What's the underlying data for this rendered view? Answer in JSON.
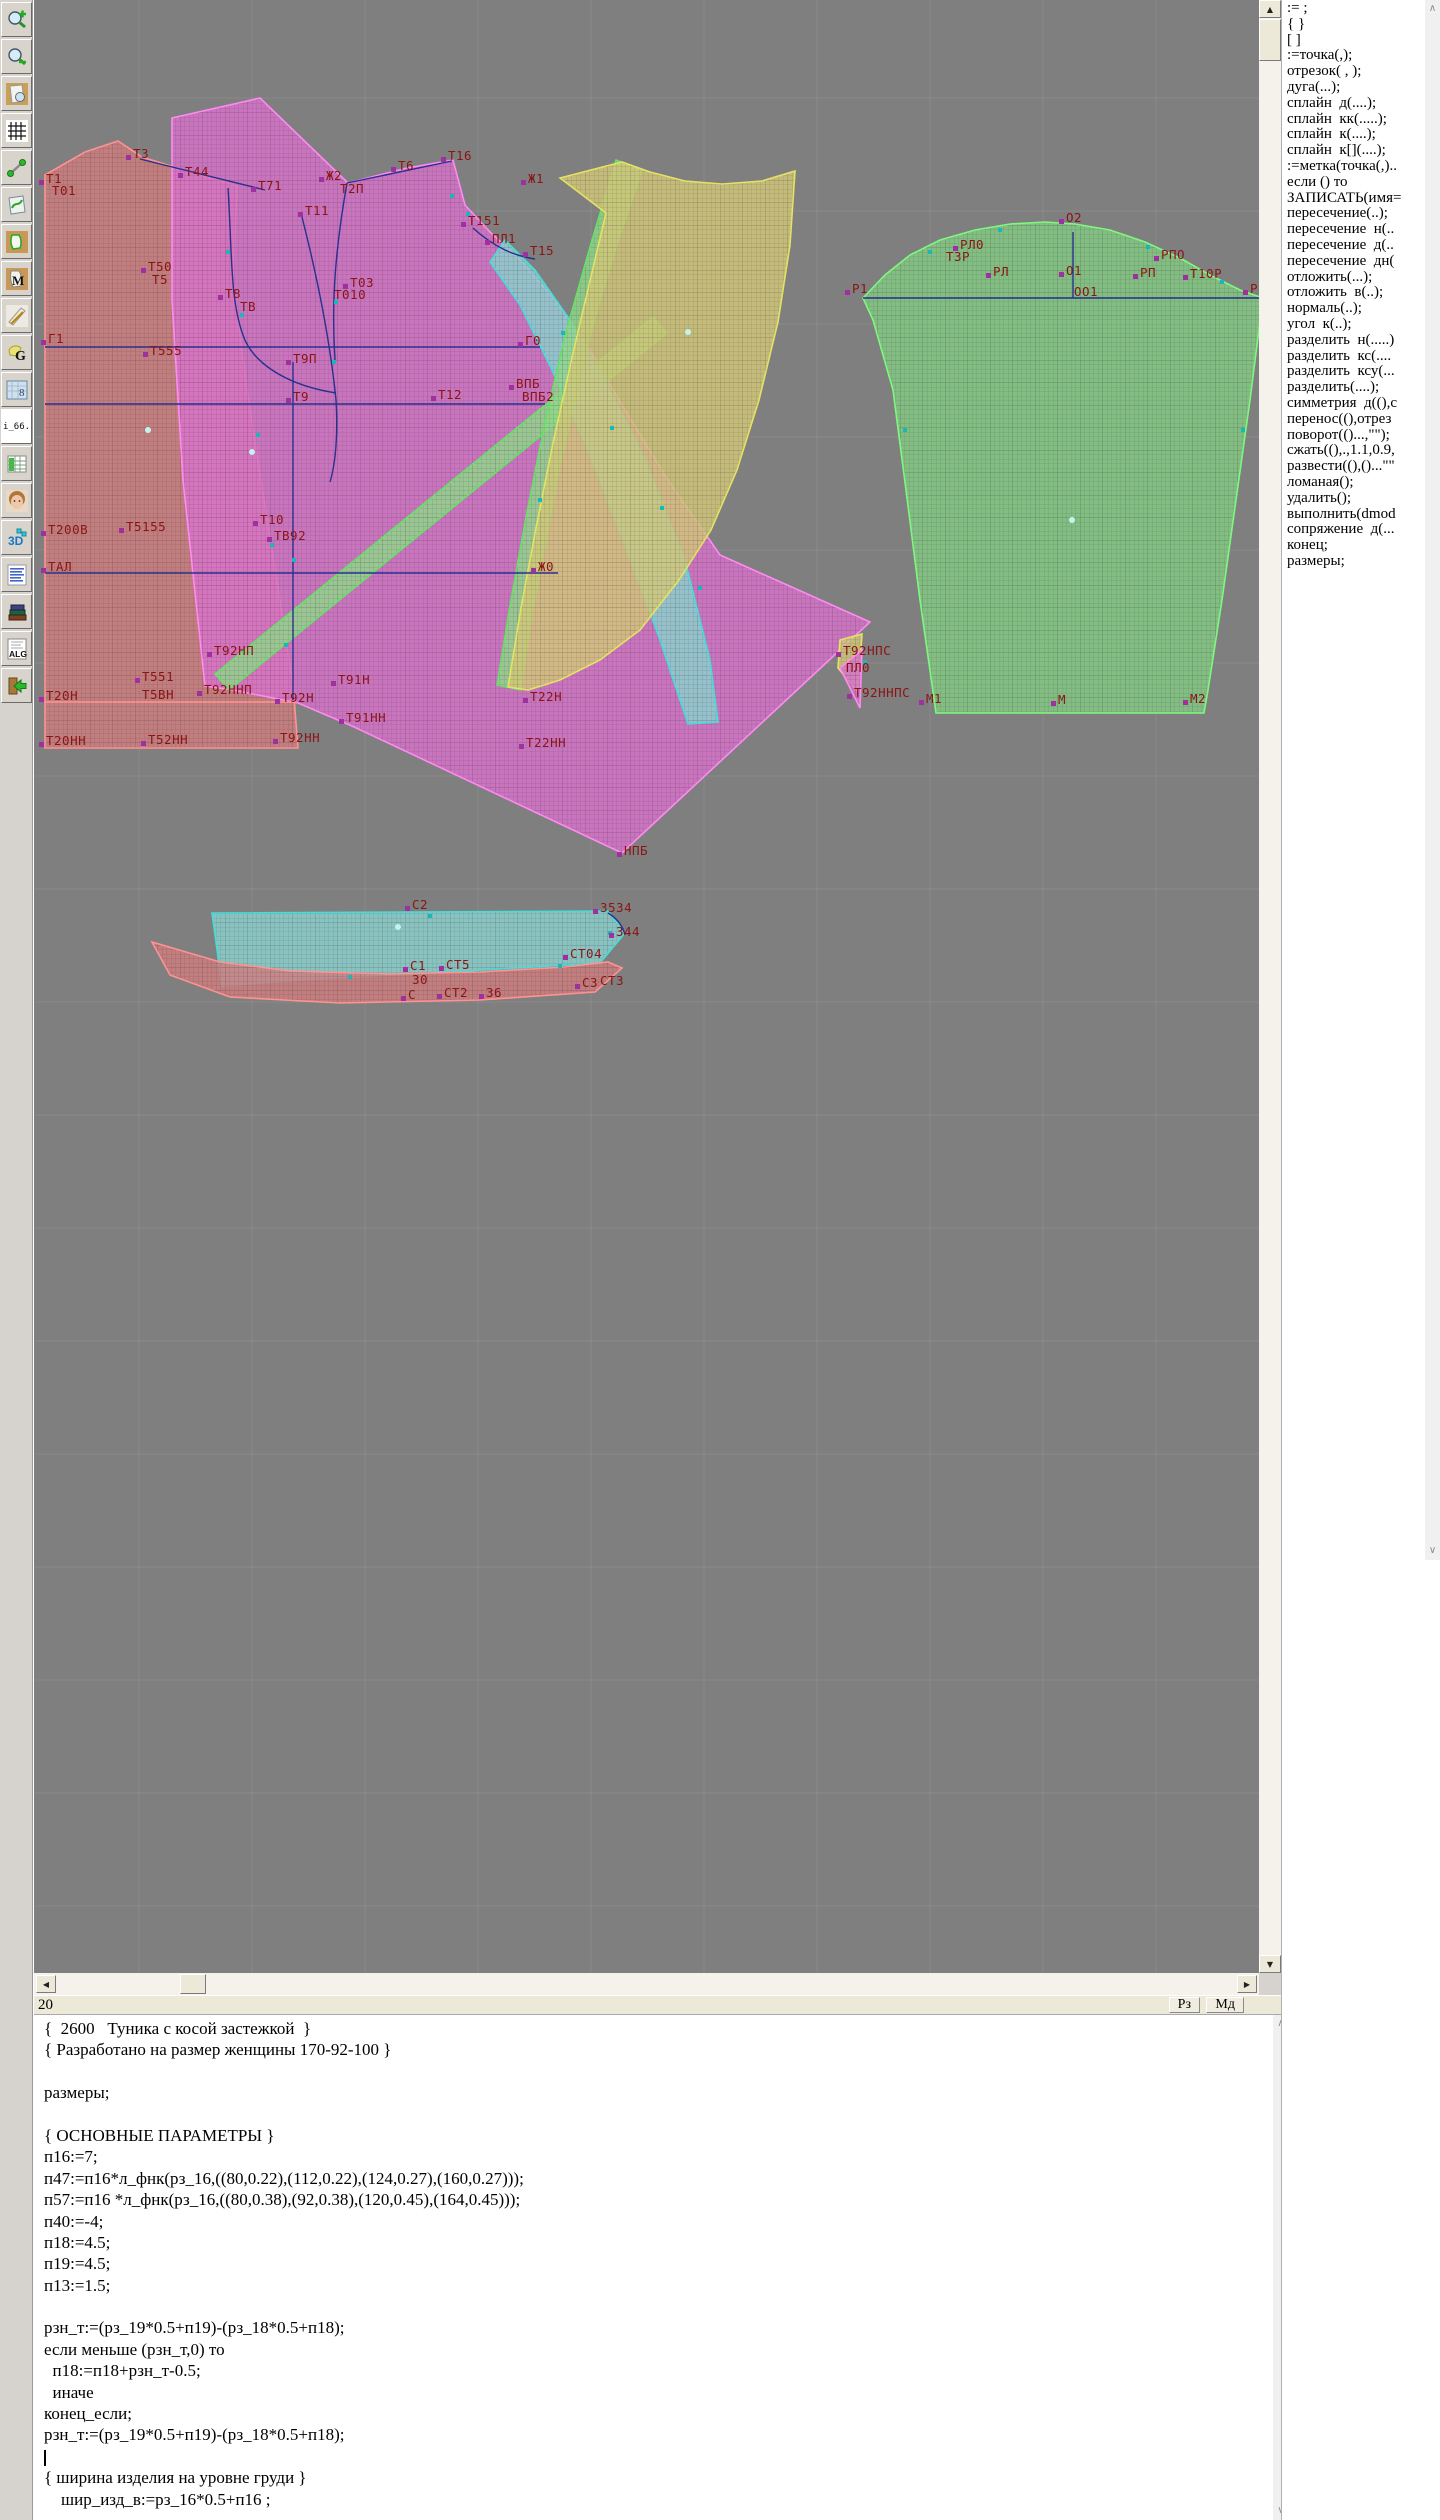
{
  "toolbar": {
    "buttons": [
      {
        "name": "zoom-in-button",
        "icon": "zoomin"
      },
      {
        "name": "zoom-out-button",
        "icon": "zoomout"
      },
      {
        "name": "preview-pattern-button",
        "icon": "preview"
      },
      {
        "name": "grid-button",
        "icon": "grid"
      },
      {
        "name": "measure-line-button",
        "icon": "measure"
      },
      {
        "name": "curves-button",
        "icon": "curvepage"
      },
      {
        "name": "pattern-piece-button",
        "icon": "piece"
      },
      {
        "name": "pattern-m-button",
        "icon": "pieceM"
      },
      {
        "name": "draft-tools-button",
        "icon": "ruler"
      },
      {
        "name": "pattern-g-button",
        "icon": "pieceG"
      },
      {
        "name": "blueprint-button",
        "icon": "blueprint"
      },
      {
        "name": "file-i66-button",
        "icon": "i66",
        "text": "i_66."
      },
      {
        "name": "size-table-button",
        "icon": "table"
      },
      {
        "name": "model-photo-button",
        "icon": "face"
      },
      {
        "name": "view-3d-button",
        "icon": "threed"
      },
      {
        "name": "text-list-button",
        "icon": "list"
      },
      {
        "name": "library-button",
        "icon": "books"
      },
      {
        "name": "algorithm-button",
        "icon": "alg"
      },
      {
        "name": "exit-button",
        "icon": "exit"
      }
    ]
  },
  "right_panel": {
    "items": [
      ":= ;",
      "{ }",
      "[ ]",
      ":=точка(,);",
      "отрезок( , );",
      "дуга(...);",
      "сплайн  д(....);",
      "сплайн  кк(.....);",
      "сплайн  к(....);",
      "сплайн  к[](....);",
      ":=метка(точка(,)..",
      "если () то",
      "ЗАПИСАТЬ(имя=",
      "пересечение(..);",
      "пересечение  н(..",
      "пересечение  д(..",
      "пересечение  дн(",
      "отложить(...);",
      "отложить  в(..);",
      "нормаль(..);",
      "угол  к(..);",
      "разделить  н(.....)",
      "разделить  кс(....",
      "разделить  ксу(...",
      "разделить(....);",
      "симметрия  д((),с",
      "перенос((),отрез",
      "поворот(()...,\"\");",
      "сжать((),.,1.1,0.9,",
      "развести((),()...\"\"",
      "ломаная();",
      "удалить();",
      "выполнить(dmod",
      "сопряжение  д(...",
      "конец;",
      "размеры;"
    ]
  },
  "status_bar": {
    "line_number": "20",
    "buttons": [
      "Рз",
      "Мд"
    ]
  },
  "editor": {
    "cursor_line": 20,
    "lines": [
      "{  2600   Туника с косой застежкой  }",
      "{ Разработано на размер женщины 170-92-100 }",
      "",
      "размеры;",
      "",
      "{ ОСНОВНЫЕ ПАРАМЕТРЫ }",
      "п16:=7;",
      "п47:=п16*л_фнк(рз_16,((80,0.22),(112,0.22),(124,0.27),(160,0.27)));",
      "п57:=п16 *л_фнк(рз_16,((80,0.38),(92,0.38),(120,0.45),(164,0.45)));",
      "п40:=-4;",
      "п18:=4.5;",
      "п19:=4.5;",
      "п13:=1.5;",
      "",
      "рзн_т:=(рз_19*0.5+п19)-(рз_18*0.5+п18);",
      "если меньше (рзн_т,0) то",
      "  п18:=п18+рзн_т-0.5;",
      "  иначе",
      "конец_если;",
      "рзн_т:=(рз_19*0.5+п19)-(рз_18*0.5+п18);",
      "",
      "{ ширина изделия на уровне груди }",
      "    шир_изд_в:=рз_16*0.5+п16 ;"
    ]
  },
  "canvas": {
    "bg": "#7f7f7f",
    "line_color": "#283090",
    "label_color": "#8b1414",
    "grid": {
      "step": 113,
      "x0": 139,
      "y0": 98,
      "color": "rgba(255,255,255,0.08)"
    },
    "pieces": [
      {
        "name": "back-bodice",
        "fill": "#cf7e7e",
        "stroke": "#ff9292",
        "pts": "45,175 85,152 118,141 142,157 200,175 237,186 233,280 247,390 264,500 280,600 293,685 298,748 45,748"
      },
      {
        "name": "front-bodice",
        "fill": "#d873cc",
        "stroke": "#ff8af2",
        "pts": "172,118 260,98 348,183 407,168 453,160 465,205 490,232 520,260 555,300 590,350 625,410 668,480 720,555 870,622 622,853 352,726 298,703 233,690 205,686 183,480 172,300"
      },
      {
        "name": "bias-band-long",
        "fill": "#8fd88a",
        "stroke": "#66e066",
        "pts": "653,317 667,333 229,690 215,674"
      },
      {
        "name": "side-panel-cyan",
        "fill": "#8ad2ce",
        "stroke": "#46dcd8",
        "pts": "505,240 535,270 570,320 605,380 645,460 685,560 710,660 718,722 688,724 660,640 625,545 588,450 552,370 520,305 490,262"
      },
      {
        "name": "bias-band-front",
        "fill": "#8fd88a",
        "stroke": "#66e066",
        "pts": "616,160 642,170 620,235 597,310 577,390 559,470 544,550 531,620 521,690 497,685 511,600 527,512 545,422 566,332 590,247"
      },
      {
        "name": "side-panel-yellow",
        "fill": "#d2c878",
        "stroke": "#e2e264",
        "pts": "560,178 622,162 650,172 685,181 722,184 762,181 795,171 790,245 778,322 759,400 737,470 711,530 679,580 640,630 600,660 560,680 528,690 508,687 521,608 536,528 553,443 573,353 593,268 606,213"
      },
      {
        "name": "sleeve",
        "fill": "#82ca82",
        "stroke": "#7ef87e",
        "pts": "863,298 885,275 910,255 940,240 975,230 1010,224 1045,222 1075,224 1110,230 1145,242 1180,258 1210,275 1240,290 1263,298 1250,400 1236,500 1222,600 1208,690 1204,713 936,713 920,600 906,490 893,390 873,320"
      },
      {
        "name": "gusset-yellow",
        "fill": "#d2c878",
        "stroke": "#e2e264",
        "pts": "840,640 862,634 858,692 838,668"
      },
      {
        "name": "gusset-magenta",
        "fill": "#d873cc",
        "stroke": "#ff8af2",
        "pts": "840,668 862,650 860,708"
      },
      {
        "name": "collar-band-cyan",
        "fill": "#8ad2ce",
        "stroke": "#46dcd8",
        "pts": "212,913 608,911 625,933 600,963 450,972 300,980 222,986"
      },
      {
        "name": "collar-band-red",
        "fill": "#cf7e7e",
        "stroke": "#ff9292",
        "pts": "152,942 220,962 290,971 390,974 480,972 565,967 608,962 622,968 595,992 480,1000 340,1003 230,997 170,975"
      }
    ],
    "paths": [
      {
        "d": "M45 347 H540"
      },
      {
        "d": "M45 404 H545"
      },
      {
        "d": "M45 573 H558"
      },
      {
        "d": "M293 362 V700"
      },
      {
        "d": "M140 159 L265 190"
      },
      {
        "d": "M347 183 L452 161"
      },
      {
        "d": "M228 188 C232 250 230 300 243 335 C252 362 285 385 336 393"
      },
      {
        "d": "M302 217 C318 280 330 340 336 400 C338 432 336 462 330 482"
      },
      {
        "d": "M347 183 C336 245 331 300 335 360"
      },
      {
        "d": "M473 228 C495 248 515 256 535 259"
      },
      {
        "d": "M863 298 H1263"
      },
      {
        "d": "M1073 232 V298"
      },
      {
        "d": "M608 913 C618 919 623 927 625 935"
      },
      {
        "d": "M45 702 H297",
        "s": "#ff9292"
      }
    ],
    "labels": [
      [
        46,
        183,
        "Т1",
        1
      ],
      [
        52,
        195,
        "Т01",
        0
      ],
      [
        133,
        158,
        "Т3",
        1
      ],
      [
        185,
        176,
        "Т44",
        1
      ],
      [
        258,
        190,
        "Т71",
        1
      ],
      [
        326,
        180,
        "Ж2",
        1
      ],
      [
        340,
        193,
        "Т2П",
        0
      ],
      [
        305,
        215,
        "Т11",
        1
      ],
      [
        398,
        170,
        "Т6",
        1
      ],
      [
        448,
        160,
        "Т16",
        1
      ],
      [
        528,
        183,
        "Ж1",
        1
      ],
      [
        468,
        225,
        "Т151",
        1
      ],
      [
        492,
        243,
        "ПЛ1",
        1
      ],
      [
        530,
        255,
        "Т15",
        1
      ],
      [
        148,
        271,
        "Т50",
        1
      ],
      [
        152,
        284,
        "Т5",
        0
      ],
      [
        225,
        298,
        "Т8",
        1
      ],
      [
        240,
        311,
        "ТВ",
        0
      ],
      [
        350,
        287,
        "Т03",
        1
      ],
      [
        334,
        299,
        "Т010",
        0
      ],
      [
        48,
        343,
        "Г1",
        1
      ],
      [
        150,
        355,
        "Т555",
        1
      ],
      [
        293,
        363,
        "Т9П",
        1
      ],
      [
        525,
        345,
        "Г0",
        1
      ],
      [
        293,
        401,
        "Т9",
        1
      ],
      [
        438,
        399,
        "Т12",
        1
      ],
      [
        516,
        388,
        "ВПБ",
        1
      ],
      [
        522,
        401,
        "ВПБ2",
        0
      ],
      [
        48,
        534,
        "Т200В",
        1
      ],
      [
        126,
        531,
        "Т5155",
        1
      ],
      [
        260,
        524,
        "Т10",
        1
      ],
      [
        274,
        540,
        "ТВ92",
        1
      ],
      [
        48,
        571,
        "ТАЛ",
        1
      ],
      [
        538,
        571,
        "Ж0",
        1
      ],
      [
        214,
        655,
        "Т92НП",
        1
      ],
      [
        142,
        681,
        "Т551",
        1
      ],
      [
        142,
        699,
        "Т5ВН",
        0
      ],
      [
        46,
        700,
        "Т20Н",
        1
      ],
      [
        204,
        694,
        "Т92ННП",
        1
      ],
      [
        282,
        702,
        "Т92Н",
        1
      ],
      [
        338,
        684,
        "Т91Н",
        1
      ],
      [
        346,
        722,
        "Т91НН",
        1
      ],
      [
        46,
        745,
        "Т20НН",
        1
      ],
      [
        148,
        744,
        "Т52НН",
        1
      ],
      [
        280,
        742,
        "Т92НН",
        1
      ],
      [
        530,
        701,
        "Т22Н",
        1
      ],
      [
        526,
        747,
        "Т22НН",
        1
      ],
      [
        624,
        855,
        "НПБ",
        1
      ],
      [
        843,
        655,
        "Т92НПС",
        1
      ],
      [
        846,
        672,
        "ПЛ0",
        0
      ],
      [
        854,
        697,
        "Т92ННПС",
        1
      ],
      [
        852,
        293,
        "Р1",
        1
      ],
      [
        1066,
        222,
        "О2",
        1
      ],
      [
        960,
        249,
        "РЛ0",
        1
      ],
      [
        946,
        261,
        "Т3Р",
        0
      ],
      [
        993,
        276,
        "РЛ",
        1
      ],
      [
        1066,
        275,
        "О1",
        1
      ],
      [
        1074,
        296,
        "ОО1",
        0
      ],
      [
        1140,
        277,
        "РП",
        1
      ],
      [
        1161,
        259,
        "РПО",
        1
      ],
      [
        1190,
        278,
        "Т10Р",
        1
      ],
      [
        1250,
        293,
        "Р2",
        1
      ],
      [
        926,
        703,
        "М1",
        1
      ],
      [
        1058,
        704,
        "М",
        1
      ],
      [
        1190,
        703,
        "М2",
        1
      ],
      [
        412,
        909,
        "С2",
        1
      ],
      [
        600,
        912,
        "3534",
        1
      ],
      [
        616,
        936,
        "344",
        1
      ],
      [
        570,
        958,
        "СТ04",
        1
      ],
      [
        410,
        970,
        "С1",
        1
      ],
      [
        446,
        969,
        "СТ5",
        1
      ],
      [
        412,
        984,
        "30",
        0
      ],
      [
        408,
        999,
        "С",
        1
      ],
      [
        444,
        997,
        "СТ2",
        1
      ],
      [
        486,
        997,
        "36",
        1
      ],
      [
        582,
        987,
        "С3",
        1
      ],
      [
        600,
        985,
        "СТ3",
        0
      ]
    ],
    "ticks": [
      [
        228,
        252
      ],
      [
        242,
        315
      ],
      [
        258,
        435
      ],
      [
        272,
        545
      ],
      [
        286,
        645
      ],
      [
        336,
        302
      ],
      [
        452,
        196
      ],
      [
        468,
        214
      ],
      [
        563,
        333
      ],
      [
        612,
        428
      ],
      [
        662,
        508
      ],
      [
        700,
        588
      ],
      [
        540,
        500
      ],
      [
        930,
        252
      ],
      [
        1000,
        230
      ],
      [
        1148,
        247
      ],
      [
        1222,
        282
      ],
      [
        905,
        430
      ],
      [
        1243,
        430
      ],
      [
        610,
        933
      ],
      [
        430,
        916
      ],
      [
        350,
        977
      ],
      [
        560,
        966
      ],
      [
        865,
        662
      ],
      [
        294,
        560
      ],
      [
        334,
        362
      ]
    ],
    "dots": [
      [
        148,
        430
      ],
      [
        252,
        452
      ],
      [
        688,
        332
      ],
      [
        1072,
        520
      ],
      [
        398,
        927
      ]
    ]
  }
}
